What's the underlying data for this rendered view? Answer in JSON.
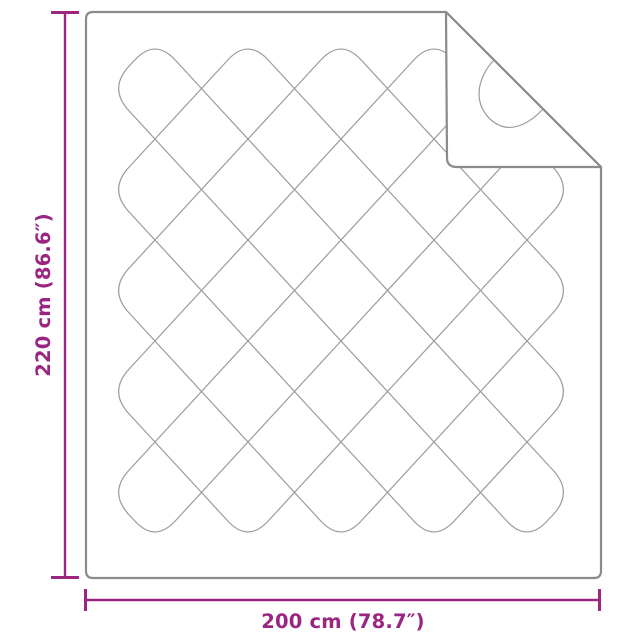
{
  "diagram": {
    "kind": "product-dimension-diagram",
    "subject": "quilted blanket with folded corner",
    "height_label": "220 cm (86.6″)",
    "width_label": "200 cm (78.7″)",
    "colors": {
      "dimension": "#9a2682",
      "outline": "#8b8b8b",
      "quilt_line": "#9b9b9b",
      "background": "#ffffff"
    }
  }
}
